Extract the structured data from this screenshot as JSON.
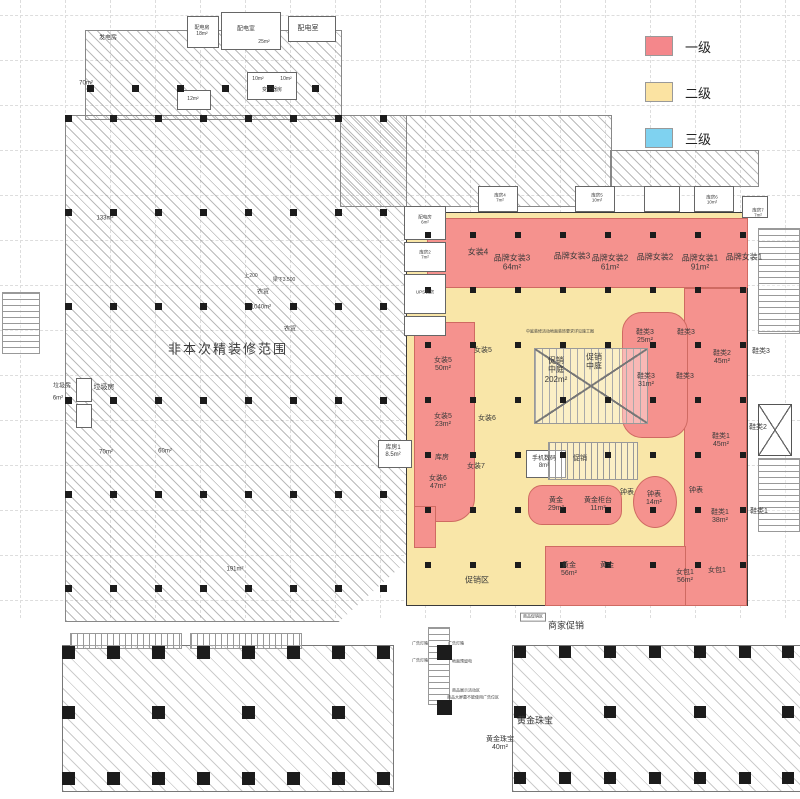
{
  "legend": {
    "items": [
      {
        "label": "一级",
        "color": "#f4878b"
      },
      {
        "label": "二级",
        "color": "#fbe3a2"
      },
      {
        "label": "三级",
        "color": "#7fd2f0"
      }
    ]
  },
  "colors": {
    "level1": "#f5928e",
    "level2": "#f9e6a8",
    "level3": "#7fd2f0",
    "wall": "#3a3a3a"
  },
  "labels": [
    {
      "t": [
        "发电房"
      ],
      "x": 108,
      "y": 39,
      "s": 6
    },
    {
      "t": [
        "70m²"
      ],
      "x": 86,
      "y": 84,
      "s": 6
    },
    {
      "t": [
        "配电房",
        "18m²"
      ],
      "x": 202,
      "y": 32,
      "s": 5
    },
    {
      "t": [
        "配电室"
      ],
      "x": 246,
      "y": 30,
      "s": 6
    },
    {
      "t": [
        "25m²"
      ],
      "x": 264,
      "y": 43,
      "s": 5
    },
    {
      "t": [
        "配电室"
      ],
      "x": 308,
      "y": 29,
      "s": 7
    },
    {
      "t": [
        "10m²"
      ],
      "x": 258,
      "y": 80,
      "s": 5
    },
    {
      "t": [
        "10m²"
      ],
      "x": 286,
      "y": 80,
      "s": 5
    },
    {
      "t": [
        "变压器房"
      ],
      "x": 272,
      "y": 91,
      "s": 5
    },
    {
      "t": [
        "12m²"
      ],
      "x": 193,
      "y": 100,
      "s": 5
    },
    {
      "t": [
        "133m²"
      ],
      "x": 105,
      "y": 219,
      "s": 6
    },
    {
      "t": [
        "上200"
      ],
      "x": 251,
      "y": 277,
      "s": 5
    },
    {
      "t": [
        "梁下3.500"
      ],
      "x": 284,
      "y": 281,
      "s": 5
    },
    {
      "t": [
        "农贸"
      ],
      "x": 263,
      "y": 293,
      "s": 6
    },
    {
      "t": [
        "1040m²"
      ],
      "x": 261,
      "y": 308,
      "s": 6
    },
    {
      "t": [
        "农贸"
      ],
      "x": 290,
      "y": 330,
      "s": 6
    },
    {
      "t": [
        "非本次精装修范围"
      ],
      "x": 228,
      "y": 349,
      "s": 13,
      "sp": 2
    },
    {
      "t": [
        "垃圾房"
      ],
      "x": 62,
      "y": 387,
      "s": 6
    },
    {
      "t": [
        "6m²"
      ],
      "x": 58,
      "y": 399,
      "s": 6
    },
    {
      "t": [
        "垃圾房"
      ],
      "x": 104,
      "y": 388,
      "s": 7
    },
    {
      "t": [
        "70m²"
      ],
      "x": 106,
      "y": 453,
      "s": 6
    },
    {
      "t": [
        "60m²"
      ],
      "x": 165,
      "y": 452,
      "s": 6
    },
    {
      "t": [
        "191m²"
      ],
      "x": 235,
      "y": 570,
      "s": 6
    },
    {
      "t": [
        "女装4"
      ],
      "x": 478,
      "y": 252,
      "s": 8
    },
    {
      "t": [
        "品牌女装3",
        "64m²"
      ],
      "x": 512,
      "y": 263,
      "s": 8
    },
    {
      "t": [
        "品牌女装3"
      ],
      "x": 572,
      "y": 256,
      "s": 8
    },
    {
      "t": [
        "品牌女装2",
        "61m²"
      ],
      "x": 610,
      "y": 263,
      "s": 8
    },
    {
      "t": [
        "品牌女装2"
      ],
      "x": 655,
      "y": 257,
      "s": 8
    },
    {
      "t": [
        "品牌女装1",
        "91m²"
      ],
      "x": 700,
      "y": 263,
      "s": 8
    },
    {
      "t": [
        "品牌女装1"
      ],
      "x": 744,
      "y": 257,
      "s": 8
    },
    {
      "t": [
        "女装5",
        "50m²"
      ],
      "x": 443,
      "y": 365,
      "s": 7
    },
    {
      "t": [
        "女装5"
      ],
      "x": 483,
      "y": 351,
      "s": 7
    },
    {
      "t": [
        "促销",
        "中庭",
        "202m²"
      ],
      "x": 556,
      "y": 370,
      "s": 8
    },
    {
      "t": [
        "促销",
        "中庭"
      ],
      "x": 594,
      "y": 362,
      "s": 8
    },
    {
      "t": [
        "女装5",
        "23m²"
      ],
      "x": 443,
      "y": 421,
      "s": 7
    },
    {
      "t": [
        "女装6"
      ],
      "x": 487,
      "y": 419,
      "s": 7
    },
    {
      "t": [
        "库房"
      ],
      "x": 442,
      "y": 458,
      "s": 7
    },
    {
      "t": [
        "女装6",
        "47m²"
      ],
      "x": 438,
      "y": 483,
      "s": 7
    },
    {
      "t": [
        "女装7"
      ],
      "x": 476,
      "y": 467,
      "s": 7
    },
    {
      "t": [
        "库房1",
        "8.5m²"
      ],
      "x": 393,
      "y": 452,
      "s": 6
    },
    {
      "t": [
        "手机数码",
        "8m²"
      ],
      "x": 544,
      "y": 463,
      "s": 6
    },
    {
      "t": [
        "促销"
      ],
      "x": 580,
      "y": 459,
      "s": 7
    },
    {
      "t": [
        "黄金",
        "29m²"
      ],
      "x": 556,
      "y": 505,
      "s": 7
    },
    {
      "t": [
        "黄金柜台",
        "11m²"
      ],
      "x": 598,
      "y": 505,
      "s": 7
    },
    {
      "t": [
        "钟表"
      ],
      "x": 627,
      "y": 493,
      "s": 7
    },
    {
      "t": [
        "钟表",
        "14m²"
      ],
      "x": 654,
      "y": 499,
      "s": 7
    },
    {
      "t": [
        "钟表"
      ],
      "x": 696,
      "y": 491,
      "s": 7
    },
    {
      "t": [
        "鞋类3",
        "25m²"
      ],
      "x": 645,
      "y": 337,
      "s": 7
    },
    {
      "t": [
        "鞋类3"
      ],
      "x": 686,
      "y": 333,
      "s": 7
    },
    {
      "t": [
        "鞋类2",
        "45m²"
      ],
      "x": 722,
      "y": 358,
      "s": 7
    },
    {
      "t": [
        "鞋类3"
      ],
      "x": 761,
      "y": 352,
      "s": 7
    },
    {
      "t": [
        "鞋类3",
        "31m²"
      ],
      "x": 646,
      "y": 381,
      "s": 7
    },
    {
      "t": [
        "鞋类3"
      ],
      "x": 685,
      "y": 377,
      "s": 7
    },
    {
      "t": [
        "鞋类1",
        "45m²"
      ],
      "x": 721,
      "y": 441,
      "s": 7
    },
    {
      "t": [
        "鞋类2"
      ],
      "x": 758,
      "y": 428,
      "s": 7
    },
    {
      "t": [
        "鞋类1",
        "38m²"
      ],
      "x": 720,
      "y": 517,
      "s": 7
    },
    {
      "t": [
        "鞋类1"
      ],
      "x": 759,
      "y": 512,
      "s": 7
    },
    {
      "t": [
        "女包1",
        "56m²"
      ],
      "x": 685,
      "y": 577,
      "s": 7
    },
    {
      "t": [
        "女包1"
      ],
      "x": 717,
      "y": 571,
      "s": 7
    },
    {
      "t": [
        "黄金",
        "56m²"
      ],
      "x": 569,
      "y": 570,
      "s": 7
    },
    {
      "t": [
        "黄金"
      ],
      "x": 607,
      "y": 566,
      "s": 7
    },
    {
      "t": [
        "促销区"
      ],
      "x": 477,
      "y": 580,
      "s": 8
    },
    {
      "t": [
        "配电房",
        "6m²"
      ],
      "x": 425,
      "y": 220,
      "s": 4.5
    },
    {
      "t": [
        "库房2",
        "7m²"
      ],
      "x": 425,
      "y": 255,
      "s": 4.5
    },
    {
      "t": [
        "UPS机房"
      ],
      "x": 425,
      "y": 292,
      "s": 4.5
    },
    {
      "t": [
        "库房4",
        "7m²"
      ],
      "x": 500,
      "y": 198,
      "s": 4.5
    },
    {
      "t": [
        "库房5",
        "10m²"
      ],
      "x": 597,
      "y": 198,
      "s": 4.5
    },
    {
      "t": [
        "库房6",
        "10m²"
      ],
      "x": 712,
      "y": 200,
      "s": 4.5
    },
    {
      "t": [
        "库房7",
        "7m²"
      ],
      "x": 758,
      "y": 213,
      "s": 4.5
    },
    {
      "t": [
        "中庭装修活动地面装饰要求详见施工图"
      ],
      "x": 560,
      "y": 332,
      "s": 4
    },
    {
      "t": [
        "商家促销"
      ],
      "x": 566,
      "y": 626,
      "s": 9
    },
    {
      "t": [
        "黄金珠宝"
      ],
      "x": 535,
      "y": 721,
      "s": 9
    },
    {
      "t": [
        "黄金珠宝",
        "40m²"
      ],
      "x": 500,
      "y": 744,
      "s": 7
    },
    {
      "t": [
        "广告灯箱"
      ],
      "x": 420,
      "y": 644,
      "s": 4
    },
    {
      "t": [
        "广告灯箱"
      ],
      "x": 456,
      "y": 644,
      "s": 4
    },
    {
      "t": [
        "广告灯箱"
      ],
      "x": 420,
      "y": 661,
      "s": 4
    },
    {
      "t": [
        "地面预留电"
      ],
      "x": 462,
      "y": 662,
      "s": 4
    },
    {
      "t": [
        "商品展示活动区"
      ],
      "x": 466,
      "y": 691,
      "s": 4
    },
    {
      "t": [
        "商品大屏幕不能使用广告位区"
      ],
      "x": 473,
      "y": 698,
      "s": 4
    },
    {
      "t": [
        "商品促销区"
      ],
      "x": 533,
      "y": 617,
      "s": 4,
      "box": true
    }
  ]
}
